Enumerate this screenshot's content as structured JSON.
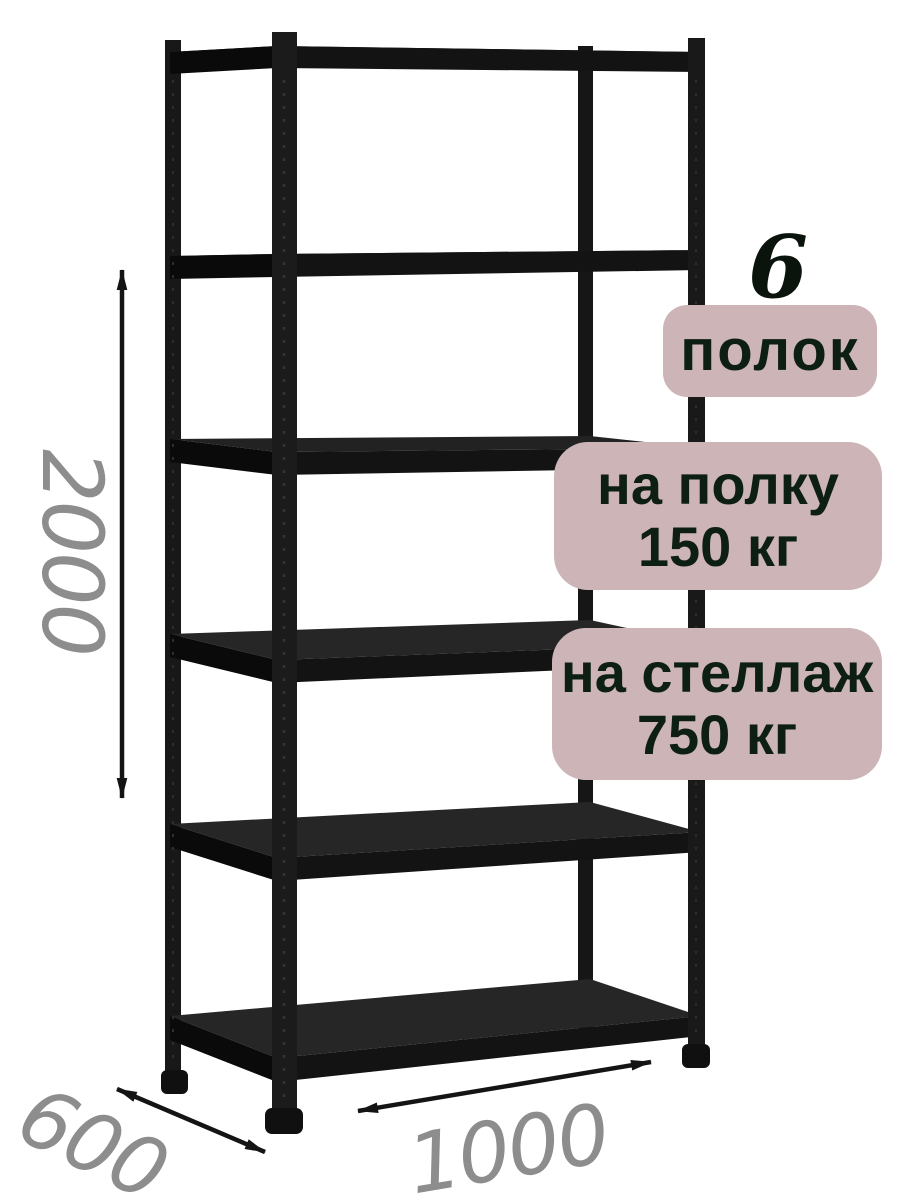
{
  "annotations": {
    "shelf_count": {
      "number": "6",
      "label": "полок"
    },
    "shelf_load": {
      "line1": "на полку",
      "line2": "150 кг"
    },
    "rack_load": {
      "line1": "на стеллаж",
      "line2": "750 кг"
    }
  },
  "dimensions": {
    "height_mm": "2000",
    "depth_mm": "600",
    "width_mm": "1000"
  },
  "product": {
    "type": "металлический стеллаж",
    "shelves": 6,
    "color": "черный"
  },
  "colors": {
    "background": "#ffffff",
    "badge_background": "#cdb4b6",
    "badge_text": "#0d1f12",
    "dimension_text": "#8d8d8d",
    "rack_metal": "#1a1a1a",
    "arrow": "#141414"
  }
}
